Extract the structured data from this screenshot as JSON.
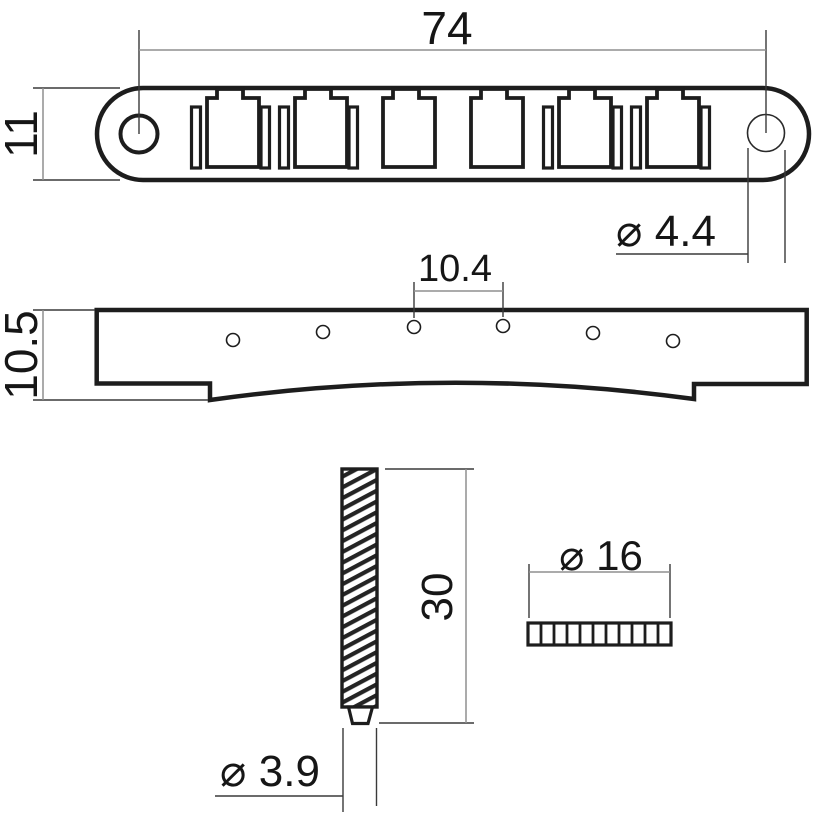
{
  "drawing": {
    "kind": "bridge technical drawing",
    "style": {
      "background": "#ffffff",
      "outline_color": "#1d1d1d",
      "extension_line_color": "#3a3a3a",
      "dimension_line_color": "#8f8f8f"
    },
    "top_view": {
      "saddle_slot_count": 6,
      "dim_length": "74",
      "dim_width": "11",
      "dim_post_hole_diameter": "⌀ 4.4"
    },
    "side_view": {
      "hole_count": 6,
      "dim_hole_spacing": "10.4",
      "dim_height": "10.5"
    },
    "stud": {
      "dim_length": "30",
      "dim_tip_diameter": "⌀ 3.9"
    },
    "thumbwheel": {
      "segment_count": 11,
      "dim_diameter": "⌀ 16"
    }
  }
}
